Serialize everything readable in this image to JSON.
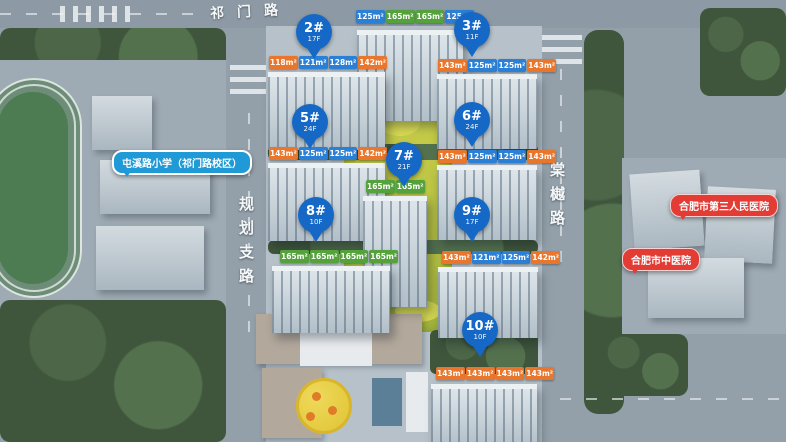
{
  "map": {
    "roads": {
      "top": "祁门路",
      "left": "规划支路",
      "right": "棠樾路"
    },
    "labels": {
      "school": "屯溪路小学（祁门路校区）",
      "hospital_1": "合肥市第三人民医院",
      "hospital_2": "合肥市中医院"
    },
    "buildings": [
      {
        "key": "b1",
        "badge": "",
        "floors": "",
        "tags": [
          {
            "label": "125m²",
            "color": "blue"
          },
          {
            "label": "165m²",
            "color": "green"
          },
          {
            "label": "165m²",
            "color": "green"
          },
          {
            "label": "125m²",
            "color": "blue"
          }
        ]
      },
      {
        "key": "b2",
        "badge": "2#",
        "floors": "17F",
        "tags": [
          {
            "label": "118m²",
            "color": "orange"
          },
          {
            "label": "121m²",
            "color": "blue"
          },
          {
            "label": "128m²",
            "color": "blue"
          },
          {
            "label": "142m²",
            "color": "orange"
          }
        ]
      },
      {
        "key": "b3",
        "badge": "3#",
        "floors": "11F",
        "tags": [
          {
            "label": "143m²",
            "color": "orange"
          },
          {
            "label": "125m²",
            "color": "blue"
          },
          {
            "label": "125m²",
            "color": "blue"
          },
          {
            "label": "143m²",
            "color": "orange"
          }
        ]
      },
      {
        "key": "b5",
        "badge": "5#",
        "floors": "24F",
        "tags": [
          {
            "label": "143m²",
            "color": "orange"
          },
          {
            "label": "125m²",
            "color": "blue"
          },
          {
            "label": "125m²",
            "color": "blue"
          },
          {
            "label": "142m²",
            "color": "orange"
          }
        ]
      },
      {
        "key": "b6",
        "badge": "6#",
        "floors": "24F",
        "tags": [
          {
            "label": "143m²",
            "color": "orange"
          },
          {
            "label": "125m²",
            "color": "blue"
          },
          {
            "label": "125m²",
            "color": "blue"
          },
          {
            "label": "143m²",
            "color": "orange"
          }
        ]
      },
      {
        "key": "b7",
        "badge": "7#",
        "floors": "21F",
        "tags": [
          {
            "label": "165m²",
            "color": "green"
          },
          {
            "label": "165m²",
            "color": "green"
          }
        ]
      },
      {
        "key": "b8",
        "badge": "8#",
        "floors": "10F",
        "tags": [
          {
            "label": "165m²",
            "color": "green"
          },
          {
            "label": "165m²",
            "color": "green"
          },
          {
            "label": "165m²",
            "color": "green"
          },
          {
            "label": "165m²",
            "color": "green"
          }
        ]
      },
      {
        "key": "b9",
        "badge": "9#",
        "floors": "17F",
        "tags": [
          {
            "label": "143m²",
            "color": "orange"
          },
          {
            "label": "121m²",
            "color": "blue"
          },
          {
            "label": "125m²",
            "color": "blue"
          },
          {
            "label": "142m²",
            "color": "orange"
          }
        ]
      },
      {
        "key": "b10",
        "badge": "10#",
        "floors": "10F",
        "tags": [
          {
            "label": "143m²",
            "color": "orange"
          },
          {
            "label": "143m²",
            "color": "orange"
          },
          {
            "label": "143m²",
            "color": "orange"
          },
          {
            "label": "143m²",
            "color": "orange"
          }
        ]
      }
    ],
    "colors": {
      "tag_orange": "#e8762c",
      "tag_blue": "#2b7fd4",
      "tag_green": "#55a23d",
      "badge_blue": "#1568c6",
      "school_label": "#1f9ad6",
      "hospital_label": "#e23c35"
    }
  }
}
